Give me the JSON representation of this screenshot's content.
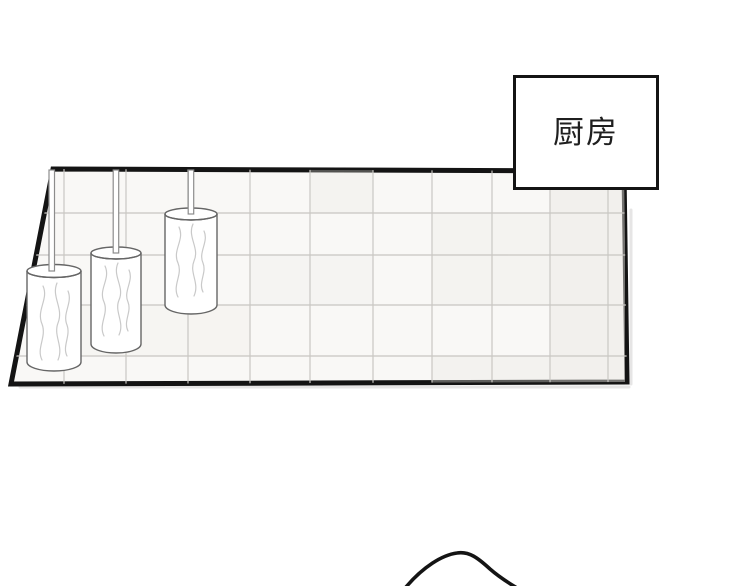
{
  "scene": {
    "label_box": {
      "label": "厨房"
    },
    "colors": {
      "ink": "#141414",
      "background": "#ffffff",
      "panel_fill": "#f9f8f6",
      "grout": "#c9c7c3",
      "tile_tint": "#e9e7e2",
      "object_outline": "#666666",
      "rod_outline": "#8c8c8c",
      "texture_line": "#c9c9c9",
      "shadow": "#e0dede",
      "label_ink": "#1f1f1f"
    },
    "objects": {
      "wall": "tiled-kitchen-wall",
      "hanging_items": [
        "hanging-roll-left",
        "hanging-roll-middle",
        "hanging-roll-right"
      ],
      "figure": "head-outline"
    }
  }
}
